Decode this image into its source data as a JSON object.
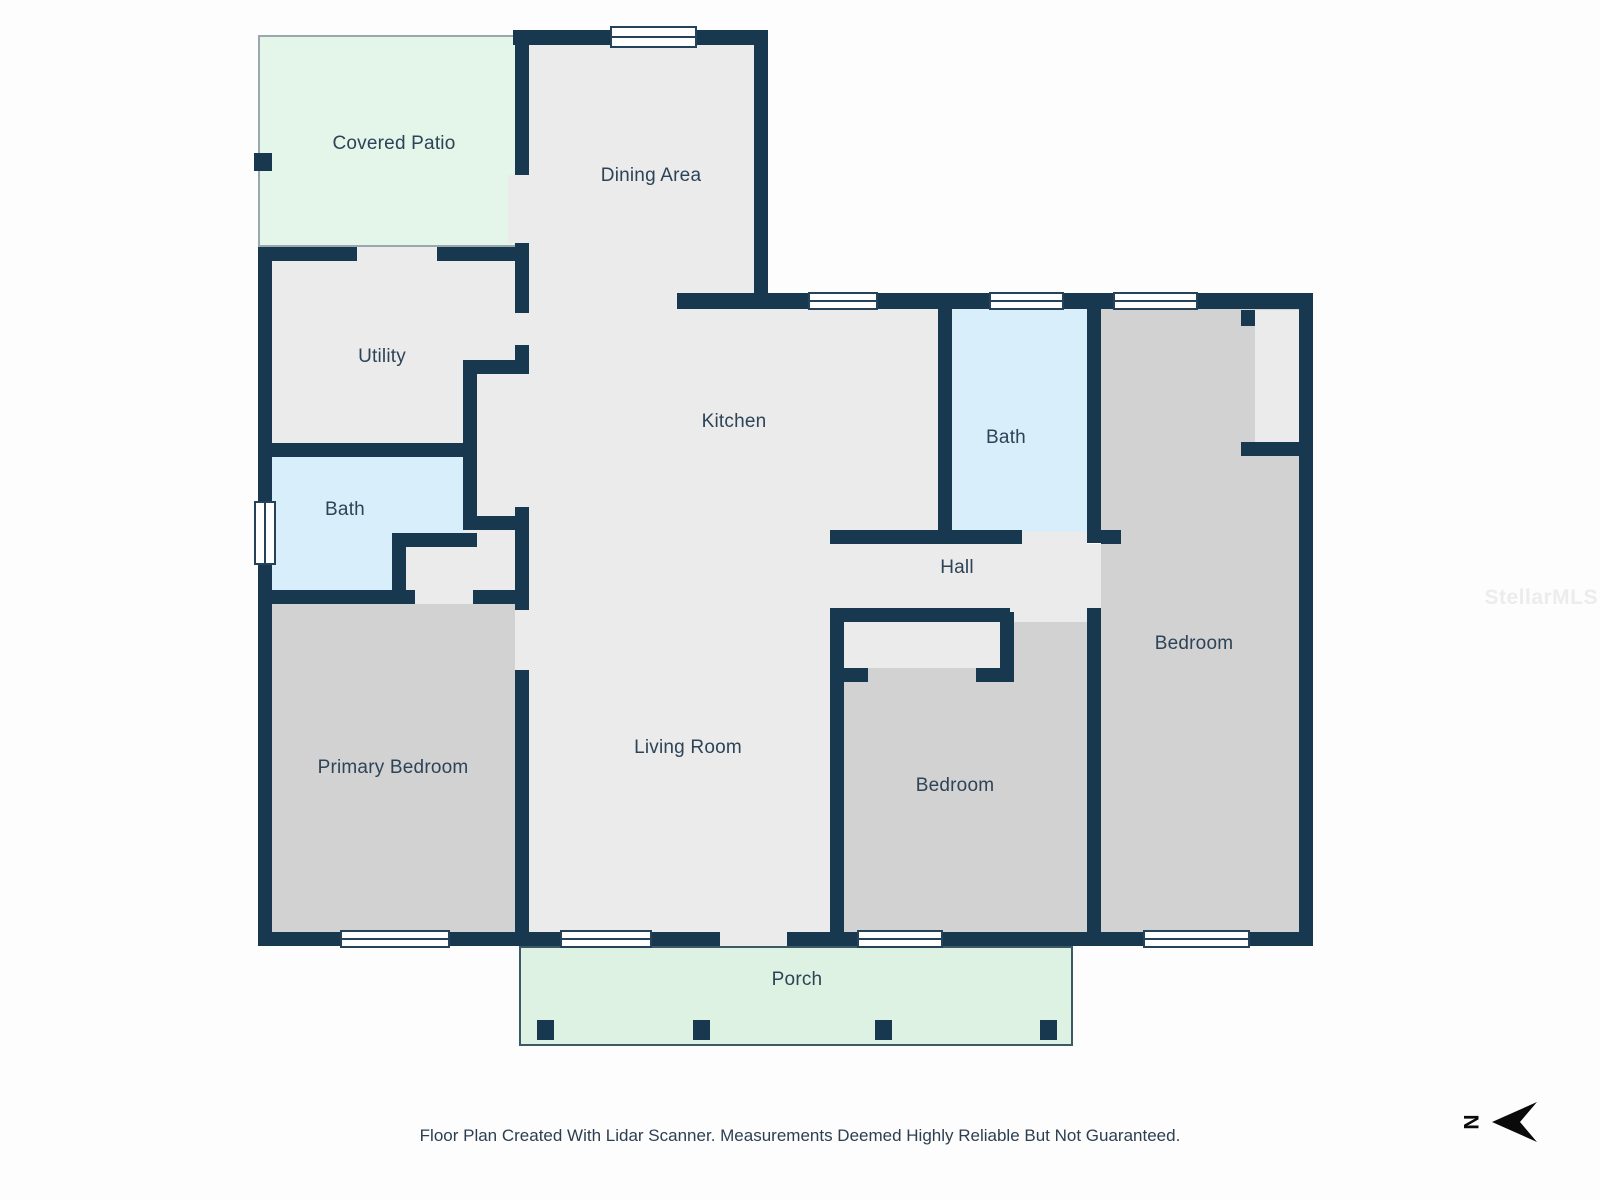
{
  "plan": {
    "rooms": [
      {
        "id": "covered-patio",
        "label": "Covered Patio"
      },
      {
        "id": "dining-area",
        "label": "Dining Area"
      },
      {
        "id": "utility",
        "label": "Utility"
      },
      {
        "id": "bath-left",
        "label": "Bath"
      },
      {
        "id": "kitchen",
        "label": "Kitchen"
      },
      {
        "id": "bath-right",
        "label": "Bath"
      },
      {
        "id": "hall",
        "label": "Hall"
      },
      {
        "id": "bedroom-right",
        "label": "Bedroom"
      },
      {
        "id": "primary-bedroom",
        "label": "Primary Bedroom"
      },
      {
        "id": "living-room",
        "label": "Living Room"
      },
      {
        "id": "bedroom-bottom",
        "label": "Bedroom"
      },
      {
        "id": "porch",
        "label": "Porch"
      }
    ],
    "compass": {
      "letter": "N"
    },
    "watermark": {
      "text": "StellarMLS"
    },
    "footer": {
      "text": "Floor Plan Created With Lidar Scanner. Measurements Deemed Highly Reliable But Not Guaranteed."
    },
    "palette": {
      "wall": "#17384e",
      "floor": "#ebebeb",
      "bedroom_floor": "#d2d2d2",
      "bath_floor": "#d9eefb",
      "patio_floor": "#e4f5ea",
      "porch_floor": "#def2e3",
      "label_text": "#2d4356"
    }
  }
}
